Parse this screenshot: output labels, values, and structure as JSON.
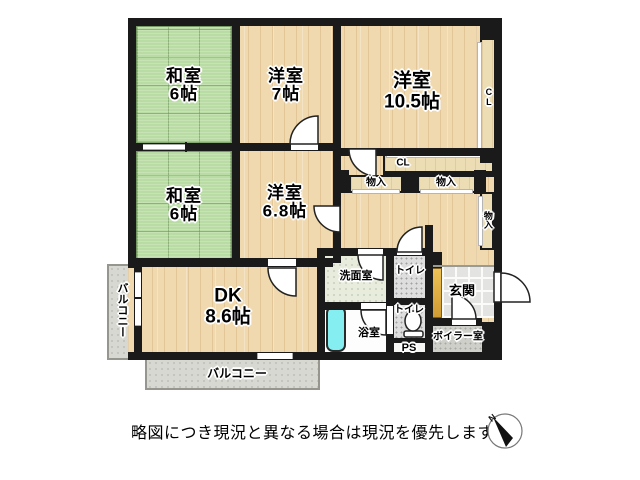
{
  "floorplan": {
    "rooms": {
      "washitsu_top": {
        "name": "和室",
        "size": "6帖"
      },
      "youshitsu_7": {
        "name": "洋室",
        "size": "7帖"
      },
      "youshitsu_105": {
        "name": "洋室",
        "size": "10.5帖"
      },
      "washitsu_mid": {
        "name": "和室",
        "size": "6帖"
      },
      "youshitsu_68": {
        "name": "洋室",
        "size": "6.8帖"
      },
      "dk": {
        "name": "DK",
        "size": "8.6帖"
      },
      "senmenshitsu": {
        "label": "洗面室"
      },
      "yokushitsu": {
        "label": "浴室"
      },
      "toilet_upper": {
        "label": "トイレ"
      },
      "toilet_lower": {
        "label": "トイレ"
      },
      "ps": {
        "label": "PS"
      },
      "genkan": {
        "label": "玄関"
      },
      "boiler_room": {
        "label": "ボイラー室"
      },
      "balcony_left": {
        "label": "バルコニー"
      },
      "balcony_bottom": {
        "label": "バルコニー"
      }
    },
    "storage": {
      "cl_right": {
        "label": "CL"
      },
      "cl_under_105": {
        "label": "CL"
      },
      "monoire_left": {
        "label": "物入"
      },
      "monoire_right": {
        "label": "物入"
      },
      "monoire_side": {
        "label": "物入"
      }
    },
    "compass": {
      "north_label": "N"
    },
    "caption": "略図につき現況と異なる場合は現況を優先します",
    "colors": {
      "wall": "#1a1a1a",
      "wood_floor": "#f0d9ae",
      "tatami": "#b9dca4",
      "balcony": "#d8d8d2",
      "tile": "#e3e3e1",
      "bathtub": "#84eef0",
      "shoe_cabinet": "#e0aa3e",
      "washroom_floor": "#e7ecdd",
      "toilet_floor": "#dedede",
      "boiler_floor": "#cfcfca"
    }
  }
}
